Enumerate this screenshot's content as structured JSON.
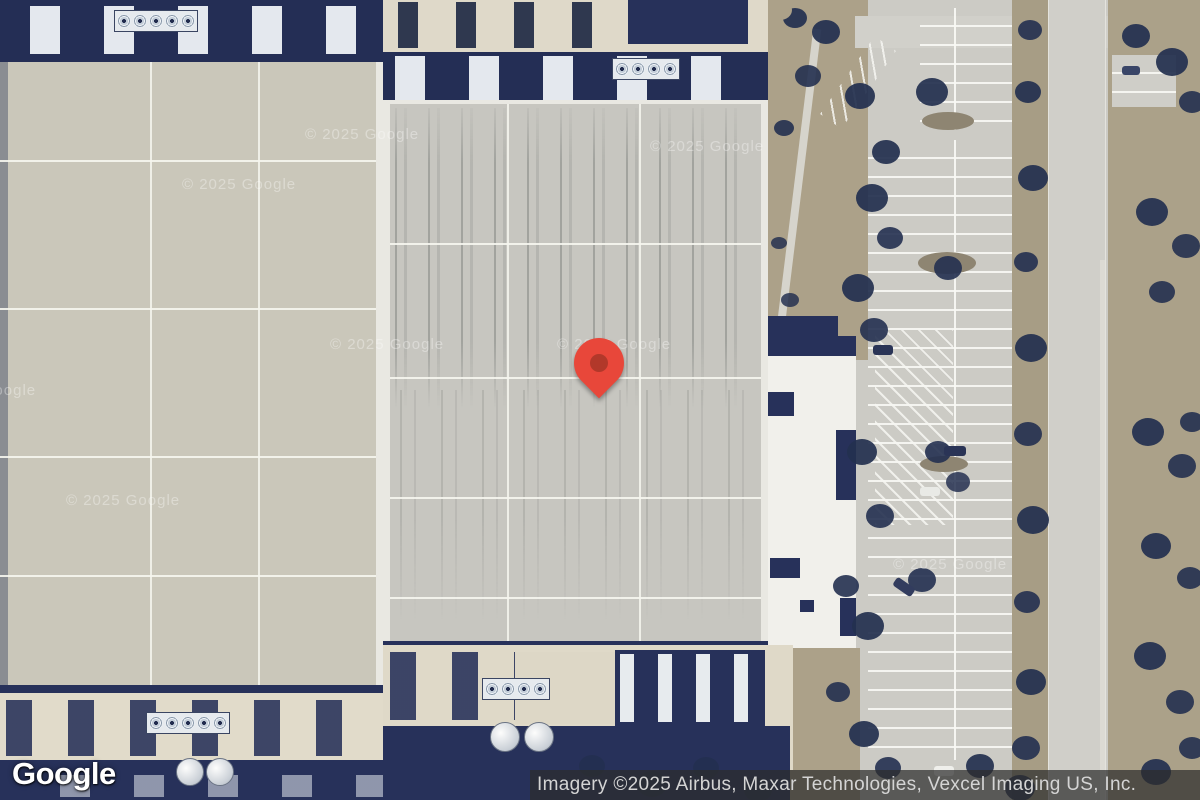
{
  "map": {
    "view": "satellite-imagery",
    "watermark_text": "© 2025 Google"
  },
  "marker": {
    "name": "location-pin",
    "body_color": "#E8473A",
    "dot_color": "#B2382A"
  },
  "footer": {
    "logo_text": "Google",
    "attribution_text": "Imagery ©2025 Airbus, Maxar Technologies, Vexcel Imaging US, Inc."
  }
}
